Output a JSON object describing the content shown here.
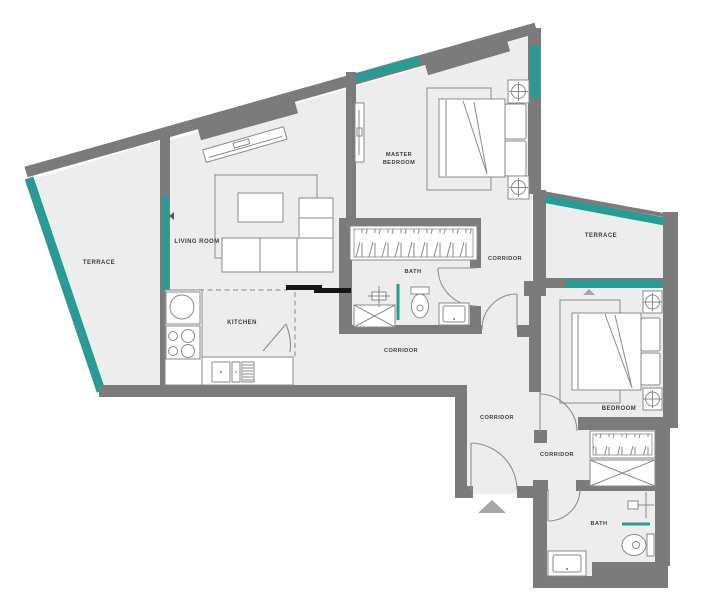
{
  "rooms": {
    "terrace_left": "TERRACE",
    "living_room": "LIVING ROOM",
    "kitchen": "KITCHEN",
    "master_bedroom_line1": "MASTER",
    "master_bedroom_line2": "BEDROOM",
    "bath_master": "BATH",
    "corridor_master": "CORRIDOR",
    "terrace_right": "TERRACE",
    "corridor_main": "CORRIDOR",
    "corridor_entry": "CORRIDOR",
    "bedroom": "BEDROOM",
    "corridor_bedroom": "CORRIDOR",
    "bath_second": "BATH"
  },
  "colors": {
    "wall": "#7b7b7b",
    "window": "#2b9a94",
    "floor": "#ededed",
    "outline": "#8a8a8a",
    "label": "#3d3d3d",
    "counter": "#151515",
    "arrow": "#a7a7a7"
  },
  "symbols": {
    "entrance_arrow": "up-triangle",
    "lamp": "circle-cross",
    "wardrobe": "diagonal-hatch",
    "shower_tray": "crossed-box",
    "window_glass": "teal-band"
  }
}
